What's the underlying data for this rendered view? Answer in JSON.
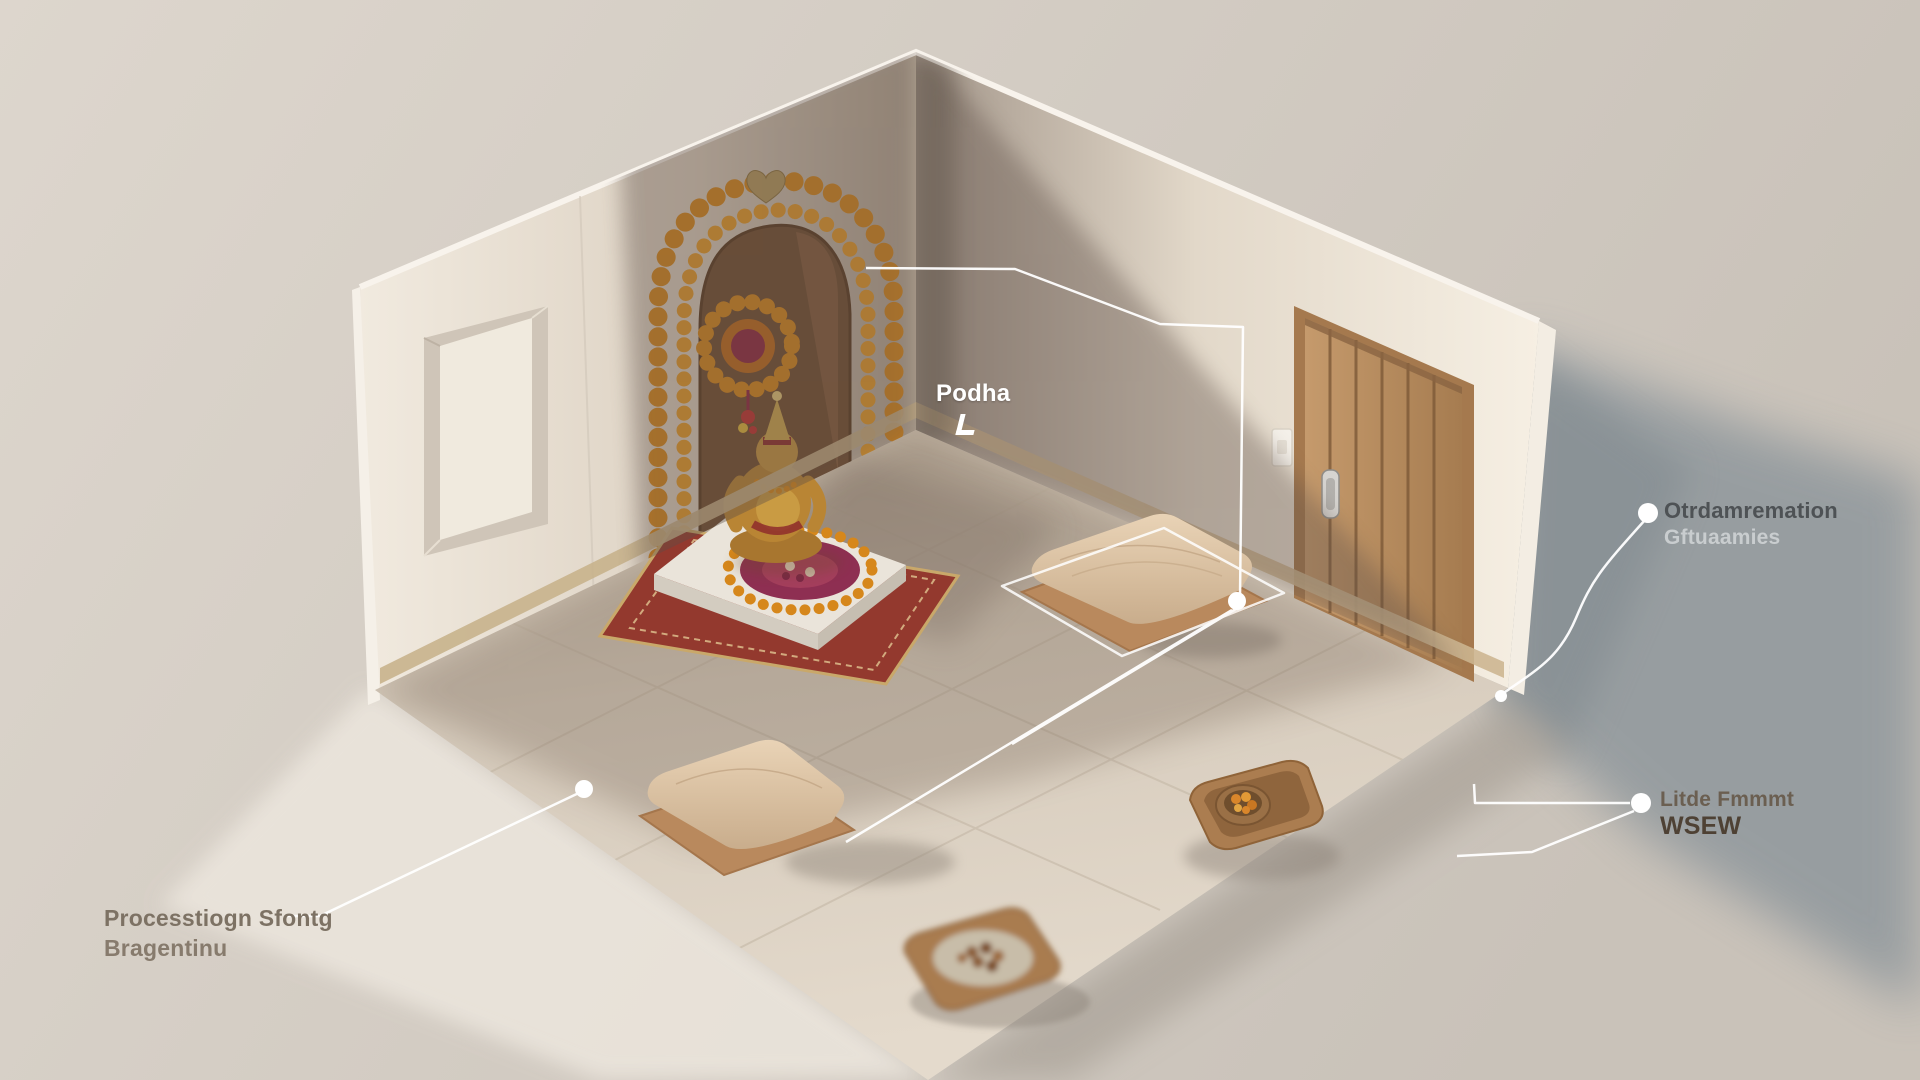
{
  "scene": {
    "objects": [
      "shrine-alcove",
      "marigold-garland",
      "flower-medallion",
      "deity-statue",
      "deity-platform",
      "prayer-rug",
      "flower-rangoli",
      "wall-ornament",
      "wooden-door",
      "door-handle",
      "light-switch",
      "window-opening",
      "floor-cushion",
      "jute-mat",
      "puja-tray-with-bowl",
      "prasad-tray",
      "selection-outline",
      "leader-dot"
    ]
  },
  "annotations": {
    "podha": {
      "text": "Podha",
      "icon": "corner-arrow-icon"
    },
    "right_top": {
      "line1": "Otrdamremation",
      "line2": "Gftuaamies"
    },
    "right_bottom": {
      "line1": "Litde Fmmmt",
      "line2": "WSEW"
    },
    "bottom_left": {
      "line1": "Processtiogn Sfontg",
      "line2": "Bragentinu"
    }
  },
  "colors": {
    "backdrop": "#d2cbc2",
    "cast_shadow": "#8f979c",
    "wall_lit": "#f2ebdf",
    "wall_shaded": "#857a6e",
    "floor_marble": "#d9cfc0",
    "door_wood": "#b98c5e",
    "garland_orange": "#d8891c",
    "rangoli_magenta": "#8e2f52",
    "annotation": "#ffffff"
  }
}
